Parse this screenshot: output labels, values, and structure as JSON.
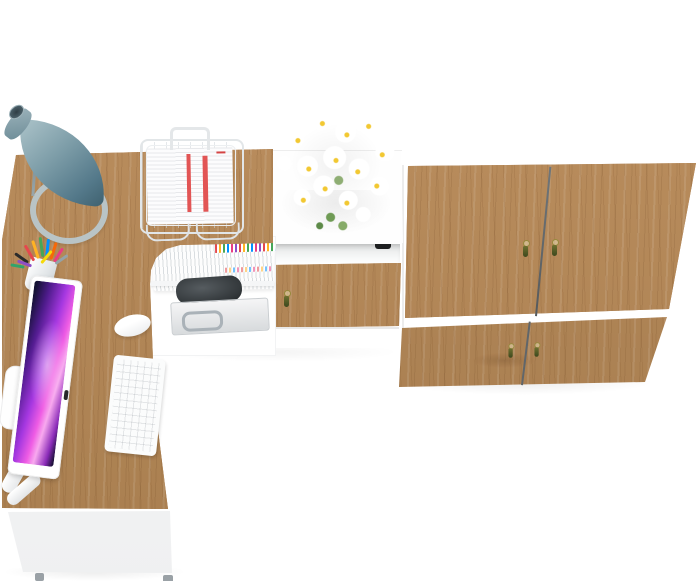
{
  "scene": {
    "title": "Home office furniture set, top-down 3D product render",
    "background_color": "#ffffff",
    "items": [
      {
        "name": "corner-desk",
        "shape": "L-shaped",
        "top_material": "golden oak wood",
        "top_color": "#b2855a",
        "front_panel_color": "#ffffff",
        "feet_count": 2
      },
      {
        "name": "desk-lamp",
        "style": "cone shade",
        "shade_color": "#6f8e9a",
        "base_color": "#b6c2c4"
      },
      {
        "name": "document-tray",
        "material": "white wire",
        "color": "#e2e6e8",
        "contents": "stacked papers with two red stripes",
        "stripe_color": "#e25555"
      },
      {
        "name": "flower-bouquet",
        "flower": "white daisies",
        "petal_color": "#ffffff",
        "center_color": "#f2c832",
        "stem_color": "#6f9b55"
      },
      {
        "name": "pen-cup",
        "cup_color": "#ffffff",
        "pen_colors": [
          "#2b2b2b",
          "#e5484d",
          "#ffb224",
          "#46a758",
          "#0091ff",
          "#f76808",
          "#e93d82",
          "#8e4ec6",
          "#94a3a8",
          "#30a46c",
          "#f5d90a"
        ]
      },
      {
        "name": "monitor",
        "style": "all-in-one with white bezel",
        "bezel_color": "#ffffff",
        "screen_wallpaper_colors": [
          "#141233",
          "#4d1b8a",
          "#a437e0",
          "#ef5ce4",
          "#f8a9ef"
        ]
      },
      {
        "name": "keyboard",
        "color": "#fbfcfc",
        "layout": "compact white keys"
      },
      {
        "name": "mouse",
        "color": "#ffffff",
        "shape": "oval"
      },
      {
        "name": "shelf-unit",
        "color": "#ffffff",
        "contents": [
          "row of white magazines with colorful page markers",
          "dark pouch",
          "light gray case with metal handle"
        ]
      },
      {
        "name": "low-cabinet",
        "top_color": "#ffffff",
        "door_material": "golden oak wood",
        "door_handle": "olive tassel",
        "open_niche": true,
        "niche_notch_color": "#1d1f20"
      },
      {
        "name": "wardrobe",
        "top_color": "#ffffff",
        "doors_count": 2,
        "drawers_count": 2,
        "door_material": "golden oak wood",
        "handle_style": "olive tassel with brass ring",
        "handles_count": 4
      }
    ]
  },
  "palette": {
    "wood_base": "#b2855a",
    "wood_dark_grain": "#5a3c22",
    "wood_highlight": "#cda372",
    "white_panel": "#ffffff",
    "lamp_shade": "#6f8e9a",
    "screen_magenta": "#ef5ce4",
    "paper_stripe_red": "#e25555",
    "tassel_olive": "#4c571f",
    "floor_shadow": "rgba(0,0,0,0.07)"
  }
}
